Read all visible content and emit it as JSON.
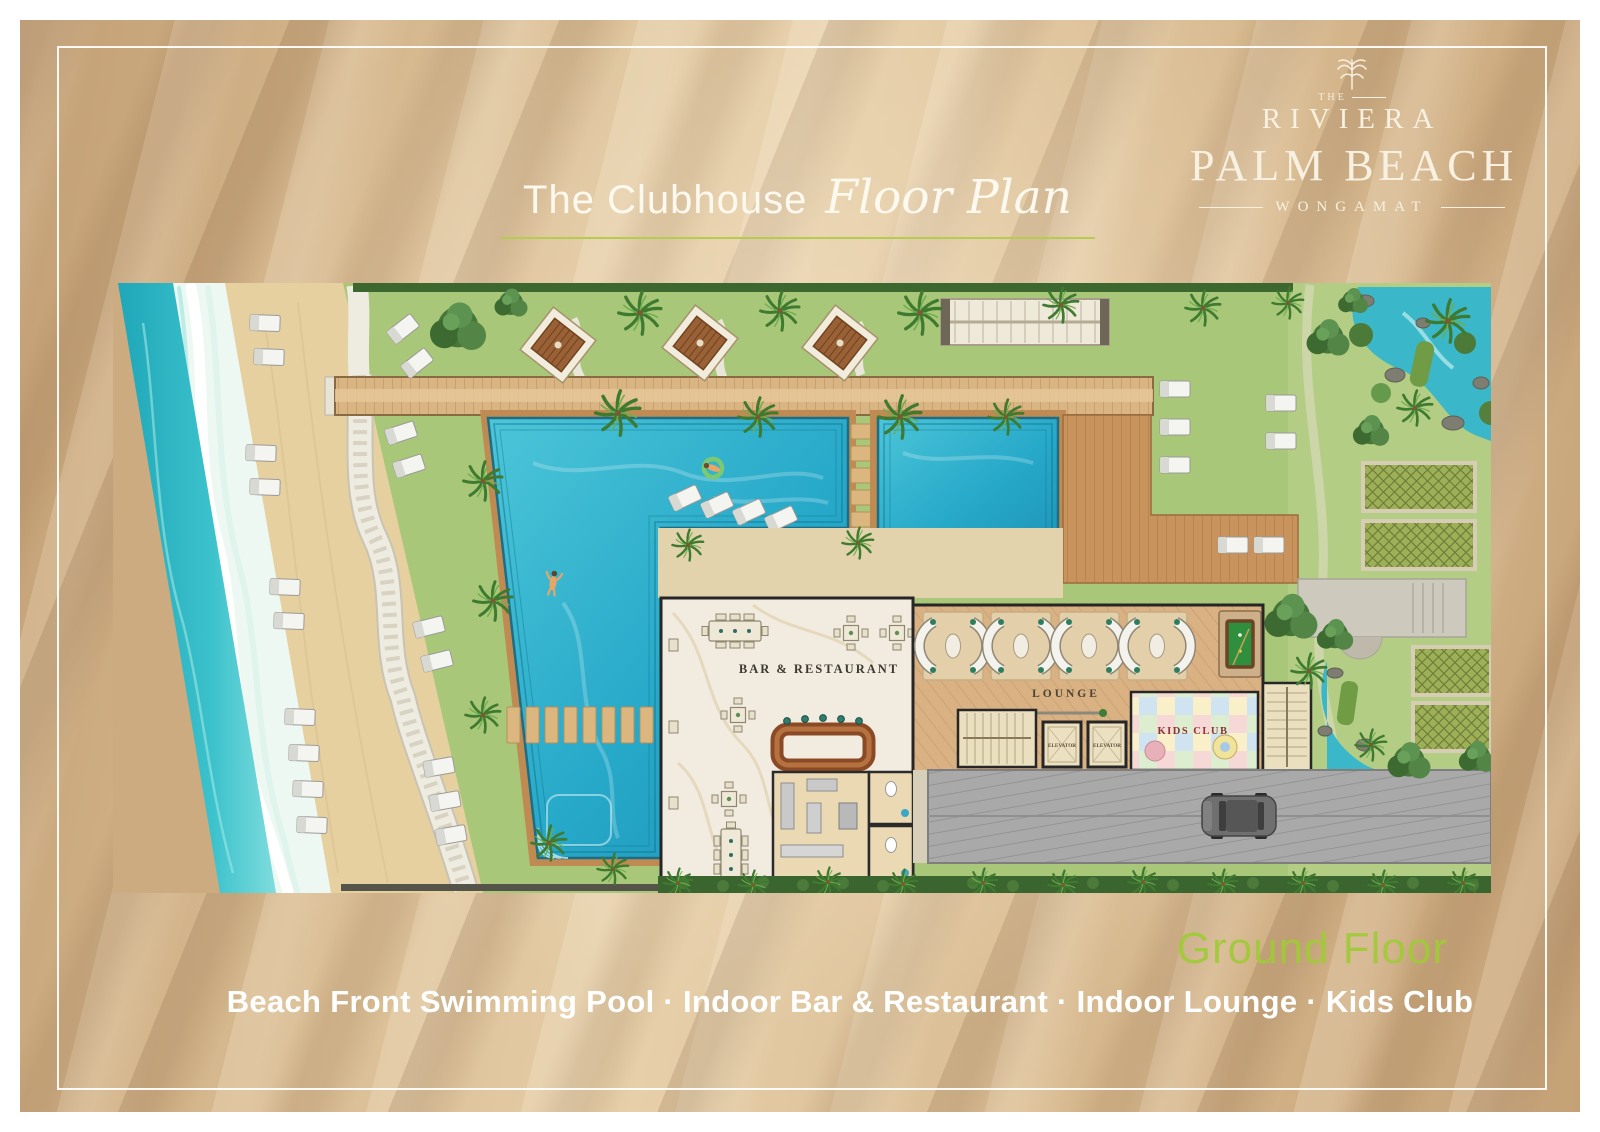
{
  "brand": {
    "the": "THE",
    "riviera": "RIVIERA",
    "palm_beach": "PALM BEACH",
    "wongamat": "WONGAMAT"
  },
  "title": {
    "regular": "The Clubhouse",
    "script": "Floor Plan"
  },
  "floor": {
    "label": "Ground Floor"
  },
  "features": {
    "line": "Beach Front Swimming Pool · Indoor Bar & Restaurant · Indoor Lounge · Kids Club"
  },
  "plan": {
    "labels": {
      "bar_restaurant": "BAR & RESTAURANT",
      "lounge": "LOUNGE",
      "kids_club": "KIDS CLUB",
      "elevators": [
        "ELEVATOR",
        "ELEVATOR"
      ]
    }
  },
  "colors": {
    "background_bronze": "#d6b88e",
    "logo_cream": "#f8f1e1",
    "title_underline_green": "#b5cc52",
    "ground_floor_green": "#a0cb39",
    "sea_turquoise": "#2db4c4",
    "pool_blue": "#27a9c9",
    "sand": "#e6d0a0",
    "lawn_green": "#a9c779",
    "deck_wood": "#c8935c",
    "marble_floor": "#f2ece0",
    "driveway_gray": "#a9a9a9"
  }
}
